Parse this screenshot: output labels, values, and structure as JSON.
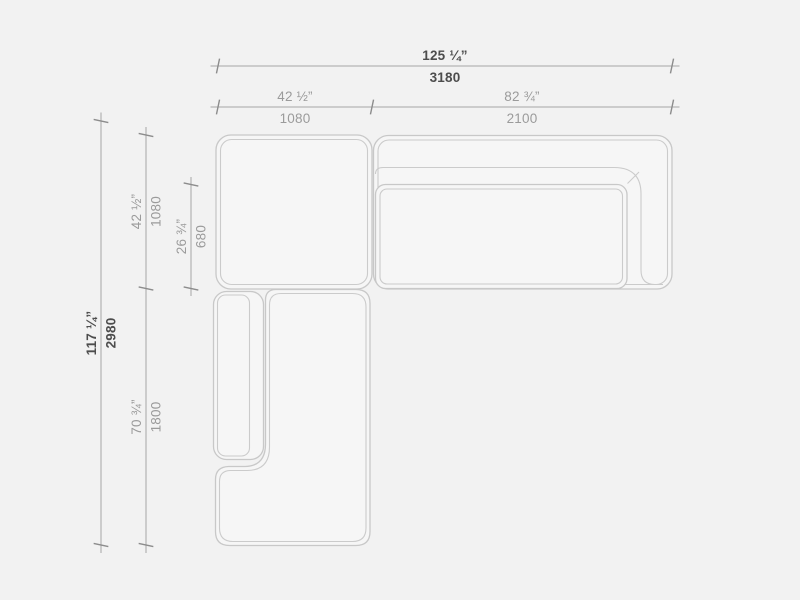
{
  "diagram": {
    "colors": {
      "background": "#f2f2f2",
      "furniture_outline": "#c8c8c8",
      "dimension_line": "#a6a6a6",
      "primary_text": "#4d4d4d",
      "secondary_text": "#9b9b9b"
    },
    "dimensions": {
      "overall_width": {
        "inches": "125 ¼”",
        "mm": "3180"
      },
      "corner_module_width": {
        "inches": "42 ½”",
        "mm": "1080"
      },
      "sofa_module_width": {
        "inches": "82 ¾”",
        "mm": "2100"
      },
      "overall_depth": {
        "inches": "117 ¼”",
        "mm": "2980"
      },
      "corner_module_depth": {
        "inches": "42 ½”",
        "mm": "1080"
      },
      "seat_depth": {
        "inches": "26 ¾”",
        "mm": "680"
      },
      "chaise_module_depth": {
        "inches": "70 ¾”",
        "mm": "1800"
      }
    }
  }
}
